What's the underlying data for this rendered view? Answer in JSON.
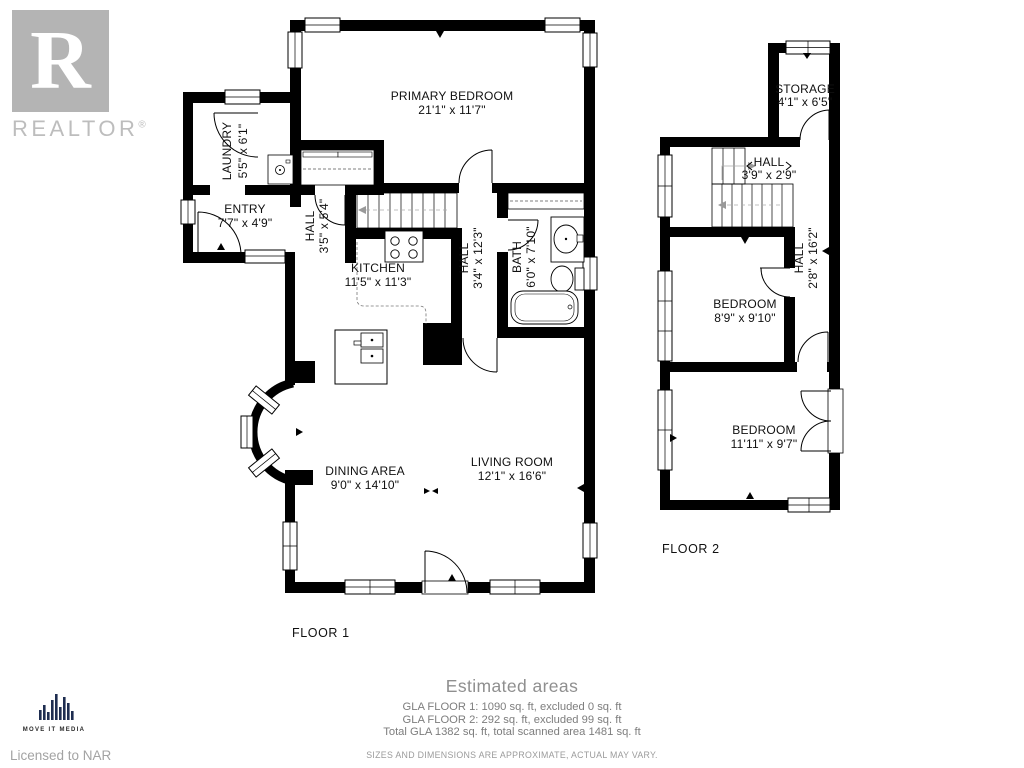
{
  "branding": {
    "realtor_letter": "R",
    "realtor_wordmark": "REALTOR",
    "registered_mark": "®",
    "media_logo_text": "MOVE IT MEDIA",
    "licensed_to": "Licensed to NAR"
  },
  "floor1": {
    "label": "FLOOR 1",
    "rooms": [
      {
        "name": "LAUNDRY",
        "dims": "5'5\" x 6'1\""
      },
      {
        "name": "ENTRY",
        "dims": "7'7\" x 4'9\""
      },
      {
        "name": "HALL",
        "dims": "3'5\" x 5'4\""
      },
      {
        "name": "PRIMARY BEDROOM",
        "dims": "21'1\" x 11'7\""
      },
      {
        "name": "KITCHEN",
        "dims": "11'5\" x 11'3\""
      },
      {
        "name": "HALL",
        "dims": "3'4\" x 12'3\""
      },
      {
        "name": "BATH",
        "dims": "6'0\" x 7'10\""
      },
      {
        "name": "DINING AREA",
        "dims": "9'0\" x 14'10\""
      },
      {
        "name": "LIVING ROOM",
        "dims": "12'1\" x 16'6\""
      }
    ]
  },
  "floor2": {
    "label": "FLOOR 2",
    "rooms": [
      {
        "name": "STORAGE",
        "dims": "4'1\" x 6'5\""
      },
      {
        "name": "HALL",
        "dims": "3'9\" x 2'9\""
      },
      {
        "name": "HALL",
        "dims": "2'8\" x 16'2\""
      },
      {
        "name": "BEDROOM",
        "dims": "8'9\" x 9'10\""
      },
      {
        "name": "BEDROOM",
        "dims": "11'11\" x 9'7\""
      }
    ]
  },
  "footer": {
    "title": "Estimated areas",
    "lines": [
      "GLA FLOOR 1: 1090 sq. ft, excluded 0 sq. ft",
      "GLA FLOOR 2: 292 sq. ft, excluded 99 sq. ft",
      "Total GLA 1382 sq. ft, total scanned area 1481 sq. ft"
    ],
    "disclaimer": "SIZES AND DIMENSIONS ARE APPROXIMATE, ACTUAL MAY VARY."
  }
}
